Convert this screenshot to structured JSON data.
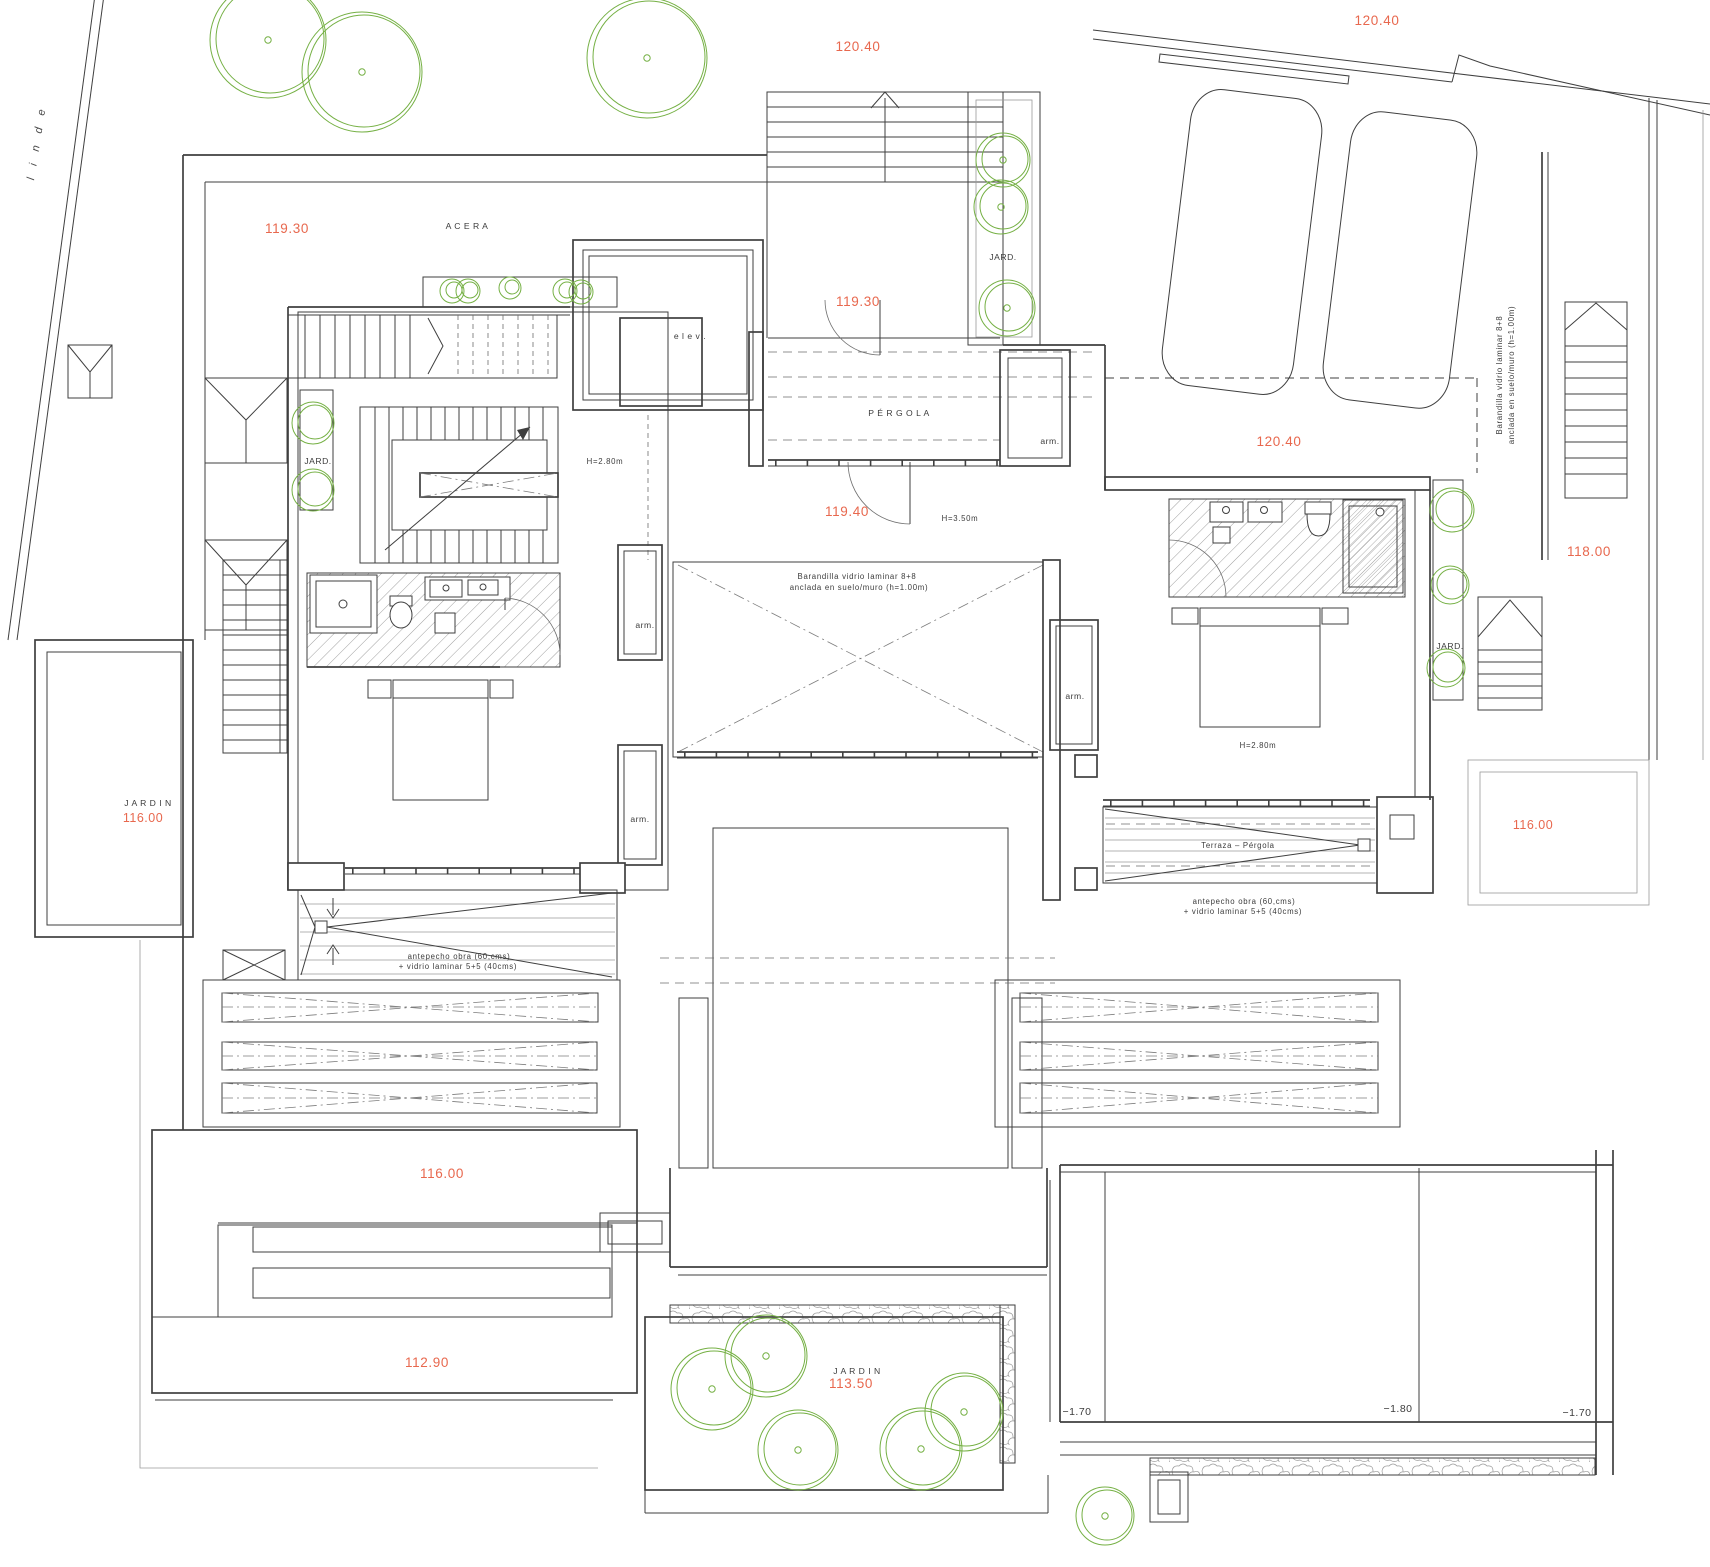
{
  "title": "Planta - vivienda pareada",
  "colors": {
    "line": "#3f3f3f",
    "light": "#9a9a9a",
    "accent_red": "#e8684e",
    "tree_green": "#75b044"
  },
  "labels": [
    {
      "name": "level-120-40-walkway",
      "text": "120.40",
      "x": 858,
      "y": 51,
      "cls": "t-red"
    },
    {
      "name": "level-120-40-street",
      "text": "120.40",
      "x": 1377,
      "y": 25,
      "cls": "t-red"
    },
    {
      "name": "level-119-30-acera",
      "text": "119.30",
      "x": 287,
      "y": 233,
      "cls": "t-red"
    },
    {
      "name": "acera-label",
      "text": "A C E R A",
      "x": 467,
      "y": 229,
      "cls": "t-sm"
    },
    {
      "name": "level-119-30-entry",
      "text": "119.30",
      "x": 858,
      "y": 306,
      "cls": "t-red"
    },
    {
      "name": "elevator-label",
      "text": "e l e v .",
      "x": 690,
      "y": 339,
      "cls": "t-sm"
    },
    {
      "name": "pergola-label",
      "text": "P É R G O L A",
      "x": 899,
      "y": 416,
      "cls": "t-sm"
    },
    {
      "name": "closet-label-1",
      "text": "arm.",
      "x": 1050,
      "y": 444,
      "cls": "t-sm"
    },
    {
      "name": "level-120-40-garage",
      "text": "120.40",
      "x": 1279,
      "y": 446,
      "cls": "t-red"
    },
    {
      "name": "height-hall-left",
      "text": "H=2.80m",
      "x": 605,
      "y": 464,
      "cls": "t-xs"
    },
    {
      "name": "level-119-40",
      "text": "119.40",
      "x": 847,
      "y": 516,
      "cls": "t-red"
    },
    {
      "name": "height-entry",
      "text": "H=3.50m",
      "x": 960,
      "y": 521,
      "cls": "t-xs"
    },
    {
      "name": "jard-label-top",
      "text": "JARD.",
      "x": 1003,
      "y": 260,
      "cls": "t-sm"
    },
    {
      "name": "jard-label-left",
      "text": "JARD.",
      "x": 318,
      "y": 464,
      "cls": "t-sm"
    },
    {
      "name": "jard-label-right",
      "text": "JARD.",
      "x": 1450,
      "y": 649,
      "cls": "t-sm"
    },
    {
      "name": "barandilla-right-line1",
      "text": "Barandilla vidrio laminar 8+8",
      "x": 1502,
      "y": 375,
      "cls": "t-xs",
      "rot": -90
    },
    {
      "name": "barandilla-right-line2",
      "text": "anclada en suelo/muro (h=1.00m)",
      "x": 1514,
      "y": 375,
      "cls": "t-xs",
      "rot": -90
    },
    {
      "name": "level-118-00",
      "text": "118.00",
      "x": 1589,
      "y": 556,
      "cls": "t-red"
    },
    {
      "name": "barandilla-court-line1",
      "text": "Barandilla vidrio laminar 8+8",
      "x": 857,
      "y": 579,
      "cls": "t-xs"
    },
    {
      "name": "barandilla-court-line2",
      "text": "anclada en suelo/muro (h=1.00m)",
      "x": 859,
      "y": 590,
      "cls": "t-xs"
    },
    {
      "name": "closet-label-2",
      "text": "arm.",
      "x": 645,
      "y": 628,
      "cls": "t-sm"
    },
    {
      "name": "closet-label-3",
      "text": "arm.",
      "x": 1075,
      "y": 699,
      "cls": "t-sm"
    },
    {
      "name": "height-bedroom-right",
      "text": "H=2.80m",
      "x": 1258,
      "y": 748,
      "cls": "t-xs"
    },
    {
      "name": "closet-label-4",
      "text": "arm.",
      "x": 640,
      "y": 822,
      "cls": "t-sm"
    },
    {
      "name": "jardin-left-label",
      "text": "J A R D I N",
      "x": 148,
      "y": 806,
      "cls": "t-sm"
    },
    {
      "name": "jardin-left-level",
      "text": "116.00",
      "x": 143,
      "y": 822,
      "cls": "t-red-s"
    },
    {
      "name": "terraza-pergola-label",
      "text": "Terraza  –  Pérgola",
      "x": 1238,
      "y": 848,
      "cls": "t-xs"
    },
    {
      "name": "antepecho-right-line1",
      "text": "antepecho obra  (60,cms)",
      "x": 1244,
      "y": 904,
      "cls": "t-xs"
    },
    {
      "name": "antepecho-right-line2",
      "text": "+  vidrio  laminar  5+5  (40cms)",
      "x": 1243,
      "y": 914,
      "cls": "t-xs"
    },
    {
      "name": "level-116-00-right",
      "text": "116.00",
      "x": 1533,
      "y": 829,
      "cls": "t-red-s"
    },
    {
      "name": "antepecho-left-line1",
      "text": "antepecho obra  (60,cms)",
      "x": 459,
      "y": 959,
      "cls": "t-xs"
    },
    {
      "name": "antepecho-left-line2",
      "text": "+  vidrio  laminar  5+5  (40cms)",
      "x": 458,
      "y": 969,
      "cls": "t-xs"
    },
    {
      "name": "level-116-00-bottom",
      "text": "116.00",
      "x": 442,
      "y": 1178,
      "cls": "t-red"
    },
    {
      "name": "level-112-90",
      "text": "112.90",
      "x": 427,
      "y": 1367,
      "cls": "t-red"
    },
    {
      "name": "jardin-bottom-label",
      "text": "J A R D I N",
      "x": 857,
      "y": 1374,
      "cls": "t-sm"
    },
    {
      "name": "jardin-bottom-level",
      "text": "113.50",
      "x": 851,
      "y": 1388,
      "cls": "t-red"
    },
    {
      "name": "pool-level-a",
      "text": "−1.70",
      "x": 1077,
      "y": 1415,
      "cls": "t-num"
    },
    {
      "name": "pool-level-b",
      "text": "−1.80",
      "x": 1398,
      "y": 1412,
      "cls": "t-num"
    },
    {
      "name": "pool-level-c",
      "text": "−1.70",
      "x": 1577,
      "y": 1416,
      "cls": "t-num"
    },
    {
      "name": "linde-label",
      "text": "l i n d e",
      "x": 40,
      "y": 143,
      "cls": "t-linde",
      "rot": -81
    }
  ],
  "trees": [
    {
      "x": 268,
      "y": 40,
      "r": 58,
      "dot": true
    },
    {
      "x": 362,
      "y": 72,
      "r": 60,
      "dot": true
    },
    {
      "x": 647,
      "y": 58,
      "r": 60,
      "dot": true
    },
    {
      "x": 452,
      "y": 291,
      "r": 12,
      "dot": false
    },
    {
      "x": 468,
      "y": 291,
      "r": 12,
      "dot": false
    },
    {
      "x": 510,
      "y": 288,
      "r": 11,
      "dot": false
    },
    {
      "x": 565,
      "y": 291,
      "r": 12,
      "dot": false
    },
    {
      "x": 581,
      "y": 292,
      "r": 12,
      "dot": false
    },
    {
      "x": 1003,
      "y": 160,
      "r": 27,
      "dot": true
    },
    {
      "x": 1001,
      "y": 207,
      "r": 27,
      "dot": true
    },
    {
      "x": 1007,
      "y": 308,
      "r": 28,
      "dot": true
    },
    {
      "x": 313,
      "y": 423,
      "r": 21,
      "dot": false
    },
    {
      "x": 313,
      "y": 490,
      "r": 21,
      "dot": false
    },
    {
      "x": 1452,
      "y": 510,
      "r": 22,
      "dot": false
    },
    {
      "x": 1450,
      "y": 585,
      "r": 19,
      "dot": false
    },
    {
      "x": 1446,
      "y": 668,
      "r": 19,
      "dot": false
    },
    {
      "x": 712,
      "y": 1389,
      "r": 41,
      "dot": true
    },
    {
      "x": 766,
      "y": 1356,
      "r": 41,
      "dot": true
    },
    {
      "x": 798,
      "y": 1450,
      "r": 40,
      "dot": true
    },
    {
      "x": 921,
      "y": 1449,
      "r": 41,
      "dot": true
    },
    {
      "x": 964,
      "y": 1412,
      "r": 39,
      "dot": true
    },
    {
      "x": 1105,
      "y": 1516,
      "r": 29,
      "dot": true
    }
  ],
  "cars": [
    {
      "cx": 1242,
      "cy": 242,
      "w": 132,
      "h": 298,
      "rot": 7
    },
    {
      "cx": 1400,
      "cy": 260,
      "w": 127,
      "h": 290,
      "rot": 7
    }
  ]
}
